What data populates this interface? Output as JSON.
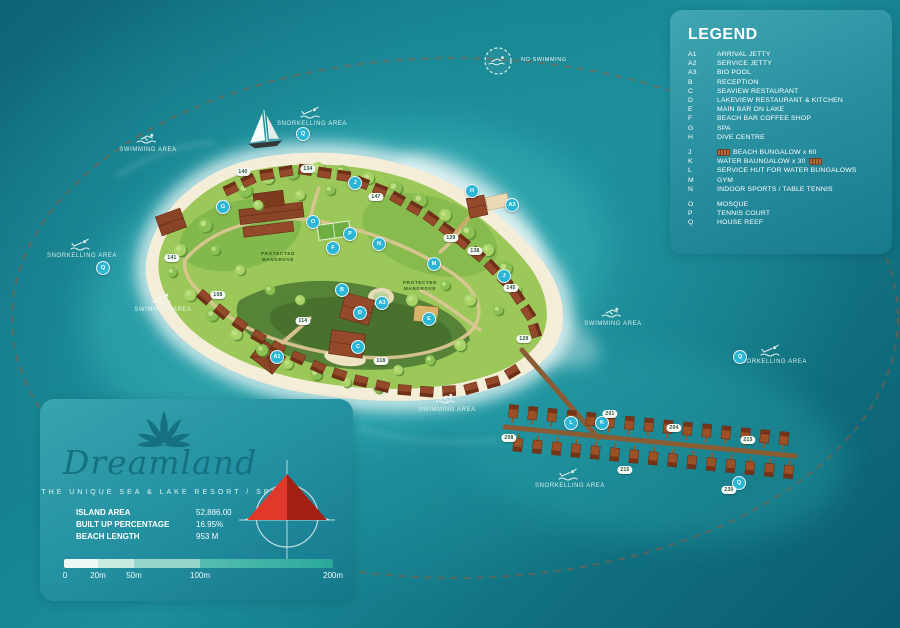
{
  "legend": {
    "title": "LEGEND",
    "items": [
      {
        "key": "A1",
        "label": "ARRIVAL JETTY"
      },
      {
        "key": "A2",
        "label": "SERVICE JETTY"
      },
      {
        "key": "A3",
        "label": "BIO POOL"
      },
      {
        "key": "B",
        "label": "RECEPTION"
      },
      {
        "key": "C",
        "label": "SEAVIEW RESTAURANT"
      },
      {
        "key": "D",
        "label": "LAKEVIEW RESTAURANT & KITCHEN"
      },
      {
        "key": "E",
        "label": "MAIN BAR ON LAKE"
      },
      {
        "key": "F",
        "label": "BEACH BAR COFFEE SHOP"
      },
      {
        "key": "G",
        "label": "SPA"
      },
      {
        "key": "H",
        "label": "DIVE CENTRE"
      },
      {
        "key": "J",
        "label": "BEACH BUNGALOW  x 60",
        "icon_before": "beach-bungalow-icon",
        "gap_before": true
      },
      {
        "key": "K",
        "label": "WATER BAUNGALOW x 30",
        "icon_after": "water-bungalow-icon"
      },
      {
        "key": "L",
        "label": "SERVICE HUT FOR WATER BUNGALOWS"
      },
      {
        "key": "M",
        "label": "GYM"
      },
      {
        "key": "N",
        "label": "INDOOR SPORTS / TABLE TENNIS"
      },
      {
        "key": "O",
        "label": "MOSQUE",
        "gap_before": true
      },
      {
        "key": "P",
        "label": "TENNIS COURT"
      },
      {
        "key": "Q",
        "label": "HOUSE REEF"
      }
    ]
  },
  "info_panel": {
    "brand": "Dreamland",
    "tagline": "THE UNIQUE SEA & LAKE RESORT / SPA",
    "stats": [
      {
        "label": "ISLAND AREA",
        "value": "52,886.00"
      },
      {
        "label": "BUILT UP PERCENTAGE",
        "value": "16.95%"
      },
      {
        "label": "BEACH LENGTH",
        "value": "953 M"
      }
    ],
    "scale_ticks": [
      {
        "text": "0",
        "x": 25
      },
      {
        "text": "20m",
        "x": 58
      },
      {
        "text": "50m",
        "x": 94
      },
      {
        "text": "100m",
        "x": 160
      },
      {
        "text": "200m",
        "x": 293
      }
    ]
  },
  "map": {
    "no_swimming_label": "NO SWIMMING",
    "area_labels": [
      {
        "text": "SWIMMING AREA",
        "icon": "swimmer-icon",
        "x": 148,
        "y": 132
      },
      {
        "text": "SNORKELLING AREA",
        "icon": "snorkeller-icon",
        "x": 82,
        "y": 238
      },
      {
        "text": "SNORKELLING AREA",
        "icon": "snorkeller-icon",
        "x": 312,
        "y": 106
      },
      {
        "text": "SWIMMING AREA",
        "icon": "swimmer-icon",
        "x": 163,
        "y": 292
      },
      {
        "text": "SWIMMING AREA",
        "icon": "swimmer-icon",
        "x": 613,
        "y": 306
      },
      {
        "text": "SNORKELLING AREA",
        "icon": "snorkeller-icon",
        "x": 772,
        "y": 344
      },
      {
        "text": "SWIMMING AREA",
        "icon": "swimmer-icon",
        "x": 447,
        "y": 392
      },
      {
        "text": "SNORKELLING AREA",
        "icon": "snorkeller-icon",
        "x": 570,
        "y": 468
      }
    ],
    "mangrove_labels": [
      {
        "line1": "PROTECTED",
        "line2": "MANGROVE",
        "x": 278,
        "y": 257
      },
      {
        "line1": "PROTECTED",
        "line2": "MANGROVE",
        "x": 420,
        "y": 286
      }
    ],
    "letter_markers": [
      {
        "key": "A1",
        "x": 277,
        "y": 357
      },
      {
        "key": "A2",
        "x": 512,
        "y": 205
      },
      {
        "key": "A3",
        "x": 382,
        "y": 303
      },
      {
        "key": "B",
        "x": 342,
        "y": 290
      },
      {
        "key": "C",
        "x": 358,
        "y": 347
      },
      {
        "key": "D",
        "x": 360,
        "y": 313
      },
      {
        "key": "E",
        "x": 429,
        "y": 319
      },
      {
        "key": "F",
        "x": 333,
        "y": 248
      },
      {
        "key": "G",
        "x": 223,
        "y": 207
      },
      {
        "key": "H",
        "x": 472,
        "y": 191
      },
      {
        "key": "J",
        "x": 355,
        "y": 183
      },
      {
        "key": "J",
        "x": 504,
        "y": 276
      },
      {
        "key": "K",
        "x": 602,
        "y": 423
      },
      {
        "key": "L",
        "x": 571,
        "y": 423
      },
      {
        "key": "M",
        "x": 434,
        "y": 264
      },
      {
        "key": "N",
        "x": 379,
        "y": 244
      },
      {
        "key": "O",
        "x": 313,
        "y": 222
      },
      {
        "key": "P",
        "x": 350,
        "y": 234
      },
      {
        "key": "Q",
        "x": 103,
        "y": 268
      },
      {
        "key": "Q",
        "x": 303,
        "y": 134
      },
      {
        "key": "Q",
        "x": 740,
        "y": 357
      },
      {
        "key": "Q",
        "x": 739,
        "y": 483
      }
    ],
    "number_pills": [
      {
        "text": "140",
        "x": 243,
        "y": 172
      },
      {
        "text": "134",
        "x": 308,
        "y": 169
      },
      {
        "text": "147",
        "x": 376,
        "y": 197
      },
      {
        "text": "139",
        "x": 451,
        "y": 238
      },
      {
        "text": "138",
        "x": 475,
        "y": 251
      },
      {
        "text": "145",
        "x": 511,
        "y": 288
      },
      {
        "text": "129",
        "x": 524,
        "y": 339
      },
      {
        "text": "141",
        "x": 172,
        "y": 258
      },
      {
        "text": "108",
        "x": 218,
        "y": 295
      },
      {
        "text": "114",
        "x": 303,
        "y": 321
      },
      {
        "text": "118",
        "x": 381,
        "y": 361
      },
      {
        "text": "208",
        "x": 509,
        "y": 438
      },
      {
        "text": "201",
        "x": 610,
        "y": 414
      },
      {
        "text": "204",
        "x": 674,
        "y": 428
      },
      {
        "text": "213",
        "x": 748,
        "y": 440
      },
      {
        "text": "215",
        "x": 625,
        "y": 470
      },
      {
        "text": "230",
        "x": 729,
        "y": 490
      }
    ]
  },
  "colors": {
    "water_center": "#2faab2",
    "water_edge": "#0a5b6e",
    "panel": "#2b93a3",
    "marker_cyan": "#2cb6d5",
    "sand": "#f4eed8",
    "vegetation": "#9cc85a",
    "vegetation_dark": "#6aa441",
    "mangrove": "#4e7d33",
    "building_brown": "#8a4526",
    "boardwalk": "#8a5c33",
    "compass_red": "#e0392b",
    "reef_line": "#9c5a3a",
    "logo_teal": "#15717f"
  }
}
